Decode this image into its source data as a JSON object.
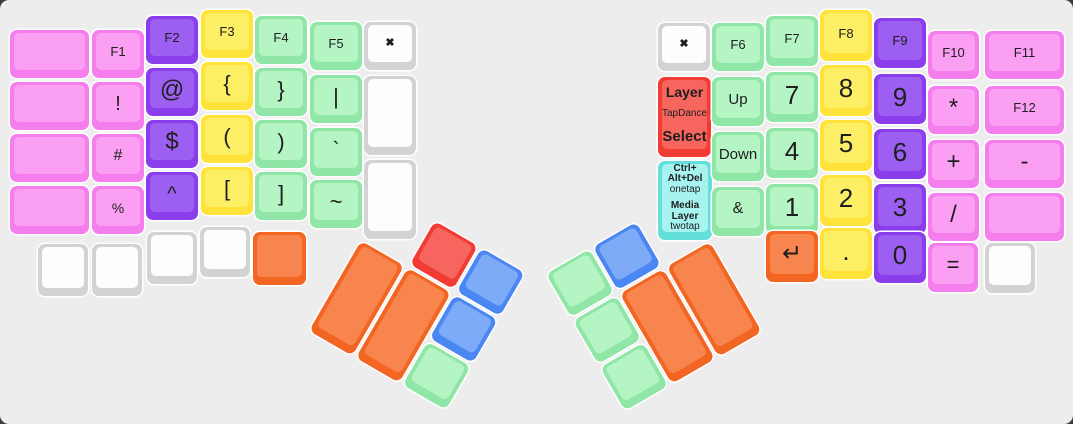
{
  "app": {
    "description": "split-ergonomic-keyboard-layout",
    "board_background": "#EDEDED",
    "page_background": "#3c3c3c",
    "key_gap_color": "#ffffff",
    "label_color": "#1e1e1e"
  },
  "palette": {
    "pink": {
      "side": "#F47FEC",
      "face": "#FB9FF3"
    },
    "purple": {
      "side": "#8A3EEB",
      "face": "#9D5FF2"
    },
    "yellow": {
      "side": "#FFE23A",
      "face": "#FCEF66"
    },
    "green": {
      "side": "#8FE6A6",
      "face": "#B5F4C3"
    },
    "white": {
      "side": "#D3D3D3",
      "face": "#FDFDFD"
    },
    "orange": {
      "side": "#F26522",
      "face": "#F9854E"
    },
    "red": {
      "side": "#F23B33",
      "face": "#F6655E"
    },
    "blue": {
      "side": "#4A87F2",
      "face": "#7DABF7"
    },
    "cyan": {
      "side": "#64DFD9",
      "face": "#A6F3EF"
    }
  },
  "keys": [
    {
      "n": "blank-l0-r1",
      "t": "",
      "c": "pink",
      "x": 10,
      "y": 30,
      "w": 79,
      "h": 48
    },
    {
      "n": "blank-l0-r2",
      "t": "",
      "c": "pink",
      "x": 10,
      "y": 82,
      "w": 79,
      "h": 48
    },
    {
      "n": "blank-l0-r3",
      "t": "",
      "c": "pink",
      "x": 10,
      "y": 134,
      "w": 79,
      "h": 48
    },
    {
      "n": "blank-l0-r4",
      "t": "",
      "c": "pink",
      "x": 10,
      "y": 186,
      "w": 79,
      "h": 48
    },
    {
      "n": "f1",
      "t": "F1",
      "c": "pink",
      "x": 92,
      "y": 30,
      "w": 52,
      "h": 48,
      "fs": 13
    },
    {
      "n": "exclaim",
      "t": "!",
      "c": "pink",
      "x": 92,
      "y": 82,
      "w": 52,
      "h": 48,
      "fs": 20
    },
    {
      "n": "hash",
      "t": "#",
      "c": "pink",
      "x": 92,
      "y": 134,
      "w": 52,
      "h": 48,
      "fs": 16
    },
    {
      "n": "percent",
      "t": "%",
      "c": "pink",
      "x": 92,
      "y": 186,
      "w": 52,
      "h": 48,
      "fs": 14
    },
    {
      "n": "f2",
      "t": "F2",
      "c": "purple",
      "x": 146,
      "y": 16,
      "w": 52,
      "h": 48,
      "fs": 13
    },
    {
      "n": "at",
      "t": "@",
      "c": "purple",
      "x": 146,
      "y": 68,
      "w": 52,
      "h": 48,
      "fs": 24
    },
    {
      "n": "dollar",
      "t": "$",
      "c": "purple",
      "x": 146,
      "y": 120,
      "w": 52,
      "h": 48,
      "fs": 24
    },
    {
      "n": "caret",
      "t": "^",
      "c": "purple",
      "x": 146,
      "y": 172,
      "w": 52,
      "h": 48,
      "fs": 20
    },
    {
      "n": "f3",
      "t": "F3",
      "c": "yellow",
      "x": 201,
      "y": 10,
      "w": 52,
      "h": 48,
      "fs": 13
    },
    {
      "n": "lbrace",
      "t": "{",
      "c": "yellow",
      "x": 201,
      "y": 62,
      "w": 52,
      "h": 48,
      "fs": 22
    },
    {
      "n": "lparen",
      "t": "(",
      "c": "yellow",
      "x": 201,
      "y": 115,
      "w": 52,
      "h": 48,
      "fs": 22
    },
    {
      "n": "lbracket",
      "t": "[",
      "c": "yellow",
      "x": 201,
      "y": 167,
      "w": 52,
      "h": 48,
      "fs": 22
    },
    {
      "n": "f4",
      "t": "F4",
      "c": "green",
      "x": 255,
      "y": 16,
      "w": 52,
      "h": 48,
      "fs": 13
    },
    {
      "n": "rbrace",
      "t": "}",
      "c": "green",
      "x": 255,
      "y": 68,
      "w": 52,
      "h": 48,
      "fs": 22
    },
    {
      "n": "rparen",
      "t": ")",
      "c": "green",
      "x": 255,
      "y": 120,
      "w": 52,
      "h": 48,
      "fs": 22
    },
    {
      "n": "rbracket",
      "t": "]",
      "c": "green",
      "x": 255,
      "y": 172,
      "w": 52,
      "h": 48,
      "fs": 22
    },
    {
      "n": "f5",
      "t": "F5",
      "c": "green",
      "x": 310,
      "y": 22,
      "w": 52,
      "h": 48,
      "fs": 13
    },
    {
      "n": "pipe",
      "t": "|",
      "c": "green",
      "x": 310,
      "y": 75,
      "w": 52,
      "h": 48,
      "fs": 22
    },
    {
      "n": "backtick",
      "t": "`",
      "c": "green",
      "x": 310,
      "y": 128,
      "w": 52,
      "h": 48,
      "fs": 22
    },
    {
      "n": "tilde",
      "t": "~",
      "c": "green",
      "x": 310,
      "y": 180,
      "w": 52,
      "h": 48,
      "fs": 22
    },
    {
      "n": "close-left",
      "t": "✖",
      "c": "white",
      "x": 364,
      "y": 22,
      "w": 52,
      "h": 48,
      "fs": 11,
      "b": 1
    },
    {
      "n": "blank-l-inner-tall1",
      "t": "",
      "c": "white",
      "x": 364,
      "y": 76,
      "w": 52,
      "h": 79
    },
    {
      "n": "blank-l-inner-tall2",
      "t": "",
      "c": "white",
      "x": 364,
      "y": 160,
      "w": 52,
      "h": 79
    },
    {
      "n": "blank-l-bottom1",
      "t": "",
      "c": "white",
      "x": 38,
      "y": 244,
      "w": 50,
      "h": 52
    },
    {
      "n": "blank-l-bottom2",
      "t": "",
      "c": "white",
      "x": 92,
      "y": 244,
      "w": 50,
      "h": 52
    },
    {
      "n": "blank-l-bottom3",
      "t": "",
      "c": "white",
      "x": 147,
      "y": 232,
      "w": 50,
      "h": 52
    },
    {
      "n": "blank-l-bottom4",
      "t": "",
      "c": "white",
      "x": 200,
      "y": 227,
      "w": 50,
      "h": 50
    },
    {
      "n": "blank-l-bottom5",
      "t": "",
      "c": "orange",
      "x": 253,
      "y": 232,
      "w": 53,
      "h": 53
    },
    {
      "n": "close-right",
      "t": "✖",
      "c": "white",
      "x": 658,
      "y": 23,
      "w": 52,
      "h": 48,
      "fs": 11,
      "b": 1
    },
    {
      "n": "layer-tapdance-select",
      "t": "",
      "c": "red",
      "x": 658,
      "y": 77,
      "w": 53,
      "h": 80,
      "spread": 1,
      "lines": [
        {
          "t": "Layer",
          "fs": 14,
          "b": 1
        },
        {
          "t": "TapDance",
          "fs": 10,
          "b": 0
        },
        {
          "t": "Select",
          "fs": 15,
          "b": 1
        }
      ]
    },
    {
      "n": "ctrl-alt-del-media-layer",
      "t": "",
      "c": "cyan",
      "x": 658,
      "y": 161,
      "w": 54,
      "h": 79,
      "lines": [
        {
          "t": "Ctrl+",
          "fs": 10,
          "b": 1
        },
        {
          "t": "Alt+Del",
          "fs": 10,
          "b": 1
        },
        {
          "t": "onetap",
          "fs": 10,
          "b": 0
        },
        {
          "t": "Media",
          "fs": 10,
          "b": 1,
          "gap": 1
        },
        {
          "t": "Layer",
          "fs": 10,
          "b": 1
        },
        {
          "t": "twotap",
          "fs": 10,
          "b": 0
        }
      ]
    },
    {
      "n": "f6",
      "t": "F6",
      "c": "green",
      "x": 712,
      "y": 23,
      "w": 52,
      "h": 48,
      "fs": 13
    },
    {
      "n": "up",
      "t": "Up",
      "c": "green",
      "x": 712,
      "y": 77,
      "w": 52,
      "h": 49,
      "fs": 15
    },
    {
      "n": "down",
      "t": "Down",
      "c": "green",
      "x": 712,
      "y": 132,
      "w": 52,
      "h": 49,
      "fs": 15
    },
    {
      "n": "ampersand",
      "t": "&",
      "c": "green",
      "x": 712,
      "y": 187,
      "w": 52,
      "h": 49,
      "fs": 16
    },
    {
      "n": "f7",
      "t": "F7",
      "c": "green",
      "x": 766,
      "y": 16,
      "w": 52,
      "h": 50,
      "fs": 13
    },
    {
      "n": "num7",
      "t": "7",
      "c": "green",
      "x": 766,
      "y": 72,
      "w": 52,
      "h": 50,
      "fs": 26
    },
    {
      "n": "num4",
      "t": "4",
      "c": "green",
      "x": 766,
      "y": 128,
      "w": 52,
      "h": 50,
      "fs": 26
    },
    {
      "n": "num1",
      "t": "1",
      "c": "green",
      "x": 766,
      "y": 184,
      "w": 52,
      "h": 50,
      "fs": 26
    },
    {
      "n": "f8",
      "t": "F8",
      "c": "yellow",
      "x": 820,
      "y": 10,
      "w": 52,
      "h": 51,
      "fs": 13
    },
    {
      "n": "num8",
      "t": "8",
      "c": "yellow",
      "x": 820,
      "y": 65,
      "w": 52,
      "h": 51,
      "fs": 26
    },
    {
      "n": "num5",
      "t": "5",
      "c": "yellow",
      "x": 820,
      "y": 120,
      "w": 52,
      "h": 51,
      "fs": 26
    },
    {
      "n": "num2",
      "t": "2",
      "c": "yellow",
      "x": 820,
      "y": 175,
      "w": 52,
      "h": 51,
      "fs": 26
    },
    {
      "n": "f9",
      "t": "F9",
      "c": "purple",
      "x": 874,
      "y": 18,
      "w": 52,
      "h": 50,
      "fs": 13
    },
    {
      "n": "num9",
      "t": "9",
      "c": "purple",
      "x": 874,
      "y": 74,
      "w": 52,
      "h": 50,
      "fs": 26
    },
    {
      "n": "num6",
      "t": "6",
      "c": "purple",
      "x": 874,
      "y": 129,
      "w": 52,
      "h": 50,
      "fs": 26
    },
    {
      "n": "num3",
      "t": "3",
      "c": "purple",
      "x": 874,
      "y": 184,
      "w": 52,
      "h": 50,
      "fs": 26
    },
    {
      "n": "f10",
      "t": "F10",
      "c": "pink",
      "x": 928,
      "y": 31,
      "w": 51,
      "h": 48,
      "fs": 13
    },
    {
      "n": "asterisk",
      "t": "*",
      "c": "pink",
      "x": 928,
      "y": 86,
      "w": 51,
      "h": 48,
      "fs": 24
    },
    {
      "n": "plus",
      "t": "+",
      "c": "pink",
      "x": 928,
      "y": 140,
      "w": 51,
      "h": 48,
      "fs": 24
    },
    {
      "n": "slash",
      "t": "/",
      "c": "pink",
      "x": 928,
      "y": 193,
      "w": 51,
      "h": 48,
      "fs": 24
    },
    {
      "n": "f11",
      "t": "F11",
      "c": "pink",
      "x": 985,
      "y": 31,
      "w": 79,
      "h": 48,
      "fs": 13
    },
    {
      "n": "f12",
      "t": "F12",
      "c": "pink",
      "x": 985,
      "y": 86,
      "w": 79,
      "h": 48,
      "fs": 13
    },
    {
      "n": "minus",
      "t": "-",
      "c": "pink",
      "x": 985,
      "y": 140,
      "w": 79,
      "h": 48,
      "fs": 24
    },
    {
      "n": "blank-r0-r4",
      "t": "",
      "c": "pink",
      "x": 985,
      "y": 193,
      "w": 79,
      "h": 48
    },
    {
      "n": "enter",
      "t": "↵",
      "c": "orange",
      "x": 766,
      "y": 231,
      "w": 52,
      "h": 51,
      "fs": 24
    },
    {
      "n": "period",
      "t": ".",
      "c": "yellow",
      "x": 820,
      "y": 228,
      "w": 52,
      "h": 51,
      "fs": 26
    },
    {
      "n": "num0",
      "t": "0",
      "c": "purple",
      "x": 874,
      "y": 232,
      "w": 52,
      "h": 51,
      "fs": 26
    },
    {
      "n": "equals",
      "t": "=",
      "c": "pink",
      "x": 928,
      "y": 243,
      "w": 50,
      "h": 49,
      "fs": 22
    },
    {
      "n": "blank-r-bottom",
      "t": "",
      "c": "white",
      "x": 985,
      "y": 243,
      "w": 50,
      "h": 50
    }
  ],
  "clusters": [
    {
      "n": "left-thumb-cluster",
      "ox": 388,
      "oy": 194,
      "rot": 30,
      "keys": [
        {
          "n": "lthumb-red",
          "t": "",
          "c": "red",
          "x": 54,
          "y": 0,
          "w": 50,
          "h": 50
        },
        {
          "n": "lthumb-blue-top",
          "t": "",
          "c": "blue",
          "x": 108,
          "y": 0,
          "w": 50,
          "h": 50
        },
        {
          "n": "lthumb-orange-outer",
          "t": "",
          "c": "orange",
          "x": 0,
          "y": 54,
          "w": 50,
          "h": 104
        },
        {
          "n": "lthumb-orange-inner",
          "t": "",
          "c": "orange",
          "x": 54,
          "y": 54,
          "w": 50,
          "h": 104
        },
        {
          "n": "lthumb-blue-mid",
          "t": "",
          "c": "blue",
          "x": 108,
          "y": 54,
          "w": 50,
          "h": 50
        },
        {
          "n": "lthumb-green",
          "t": "",
          "c": "green",
          "x": 108,
          "y": 108,
          "w": 50,
          "h": 50
        }
      ]
    },
    {
      "n": "right-thumb-cluster",
      "ox": 546,
      "oy": 274,
      "rot": -30,
      "keys": [
        {
          "n": "rthumb-green-top",
          "t": "",
          "c": "green",
          "x": 0,
          "y": 0,
          "w": 50,
          "h": 50
        },
        {
          "n": "rthumb-blue",
          "t": "",
          "c": "blue",
          "x": 54,
          "y": 0,
          "w": 50,
          "h": 50
        },
        {
          "n": "rthumb-green-mid",
          "t": "",
          "c": "green",
          "x": 0,
          "y": 54,
          "w": 50,
          "h": 50
        },
        {
          "n": "rthumb-green-bottom",
          "t": "",
          "c": "green",
          "x": 0,
          "y": 108,
          "w": 50,
          "h": 50
        },
        {
          "n": "rthumb-orange-outer",
          "t": "",
          "c": "orange",
          "x": 54,
          "y": 54,
          "w": 50,
          "h": 104
        },
        {
          "n": "rthumb-orange-inner",
          "t": "",
          "c": "orange",
          "x": 108,
          "y": 54,
          "w": 50,
          "h": 104
        }
      ]
    }
  ]
}
